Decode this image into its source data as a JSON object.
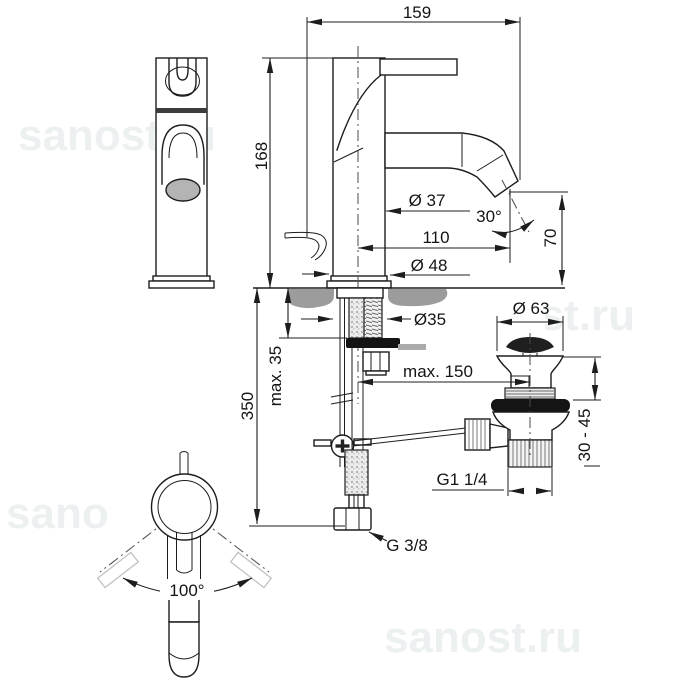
{
  "drawing": {
    "type": "faucet installation dimensional drawing",
    "views": [
      "front view",
      "side view",
      "mounting section",
      "drain assembly",
      "supply hose",
      "top swivel view"
    ]
  },
  "dimensions": {
    "overall_depth": "159",
    "body_height": "168",
    "body_diameter": "Ø 37",
    "spout_angle": "30°",
    "spout_reach": "110",
    "outlet_height": "70",
    "base_diameter": "Ø 48",
    "mounting_hole_diameter": "Ø35",
    "deck_thickness_max": "max. 35",
    "pop_up_rod_reach": "max. 150",
    "supply_length": "350",
    "drain_flange_diameter": "Ø 63",
    "basin_thickness_range": "30 - 45",
    "drain_thread": "G1 1/4",
    "supply_thread": "G 3/8",
    "swivel_angle": "100°"
  },
  "watermark": {
    "text": "sanost.ru"
  },
  "colors": {
    "line": "#1d1d1d",
    "counter_gray": "#9c9c9c",
    "gasket_black": "#141414",
    "outlet_gray": "#b4b4b4",
    "ghost_gray": "#c2c2c2",
    "watermark_gray": "#ecf0f1"
  }
}
